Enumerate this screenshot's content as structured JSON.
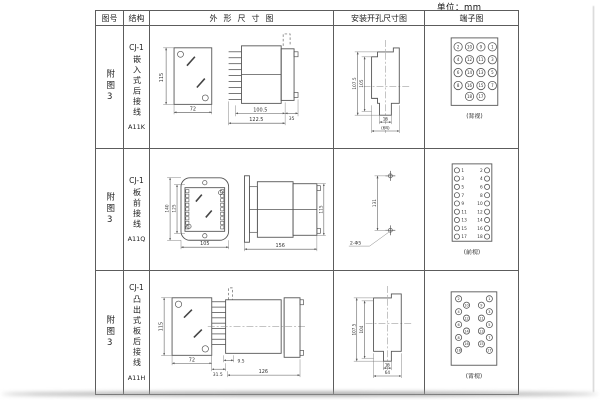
{
  "page": {
    "unit_label": "单位：mm"
  },
  "table": {
    "headers": {
      "figure": "图号",
      "structure": "结构",
      "outline": "外形尺寸图",
      "mounting": "安装开孔尺寸图",
      "terminal": "端子图"
    },
    "rows": [
      {
        "figure": "附图3",
        "model": "CJ-1",
        "structure": "嵌入式后接线",
        "code": "A11K",
        "outline": {
          "d115": "115",
          "d72": "72",
          "d100_5": "100.5",
          "d35": "35",
          "d122_5": "122.5"
        },
        "mounting": {
          "d107_5": "107.5",
          "d105": "105",
          "d16": "16",
          "d64": "(64)"
        },
        "terminal": {
          "view": "(背视)",
          "type": "grid",
          "grid": [
            [
              "2",
              "10",
              "9",
              "1"
            ],
            [
              "4",
              "12",
              "11",
              "3"
            ],
            [
              "6",
              "14",
              "13",
              "5"
            ],
            [
              "8",
              "16",
              "15",
              "7"
            ]
          ],
          "bottom": [
            "18",
            "17"
          ]
        }
      },
      {
        "figure": "附图3",
        "model": "CJ-1",
        "structure": "板前接线",
        "code": "A11Q",
        "outline": {
          "d140": "140",
          "d125": "125",
          "d105": "105",
          "d156": "156",
          "d115": "115"
        },
        "mounting": {
          "d131": "131",
          "holes": "2-Φ5"
        },
        "terminal": {
          "view": "(前视)",
          "type": "twocol",
          "left": [
            "1",
            "3",
            "5",
            "7",
            "9",
            "11",
            "13",
            "15",
            "17"
          ],
          "right": [
            "2",
            "4",
            "6",
            "8",
            "10",
            "12",
            "14",
            "16",
            "18"
          ]
        }
      },
      {
        "figure": "附图3",
        "model": "CJ-1",
        "structure": "凸出式板后接线",
        "code": "A11H",
        "outline": {
          "d115": "115",
          "d72": "72",
          "d31_5": "31.5",
          "d9_5": "9.5",
          "d126": "126"
        },
        "mounting": {
          "d107_5": "107.5",
          "d104": "104",
          "d16": "16",
          "d64": "64"
        },
        "terminal": {
          "view": "(背视)",
          "type": "staggered",
          "left_outer": [
            "2",
            "4",
            "6",
            "8",
            "18"
          ],
          "left_inner": [
            "10",
            "12",
            "14",
            "16"
          ],
          "right_outer": [
            "1",
            "3",
            "5",
            "7",
            "17"
          ],
          "right_inner": [
            "9",
            "11",
            "13",
            "15"
          ]
        }
      }
    ]
  }
}
